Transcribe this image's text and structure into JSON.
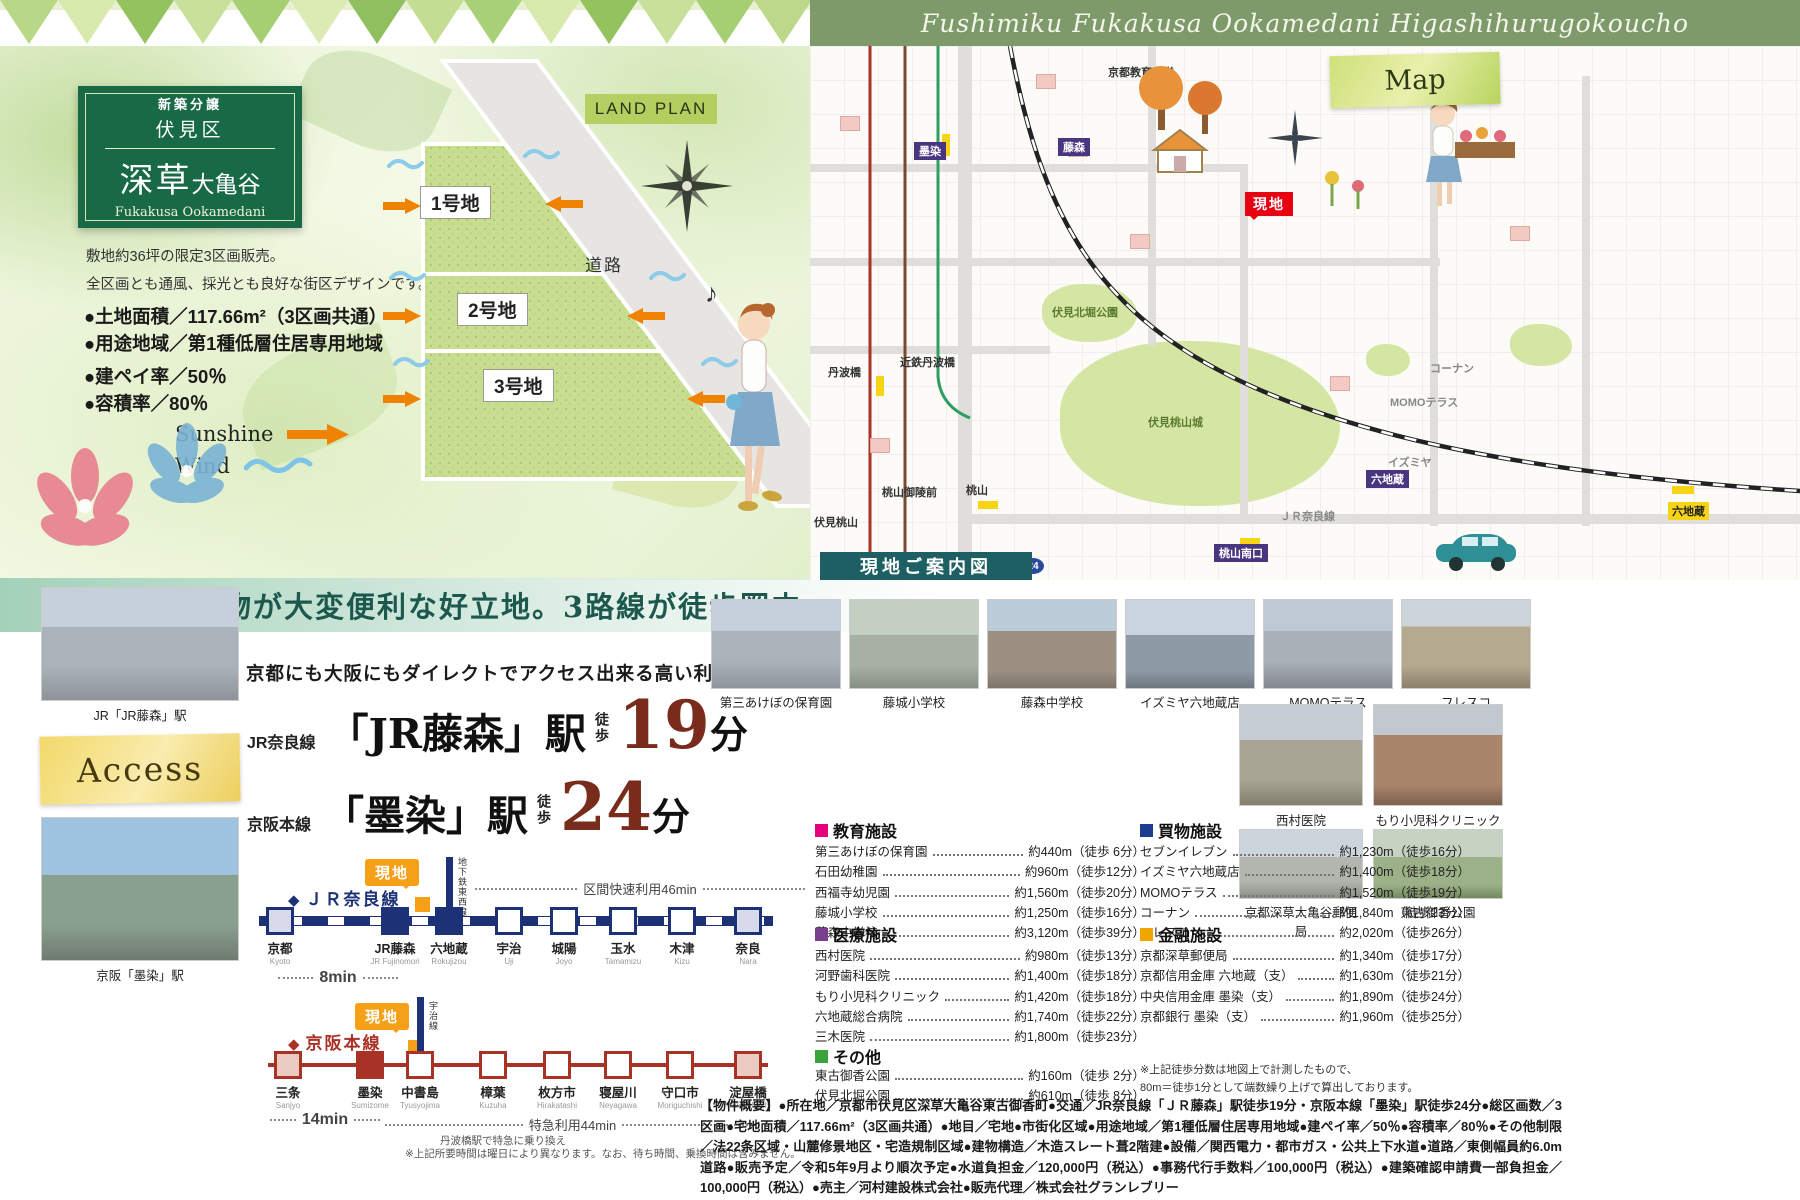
{
  "header": {
    "banner": "Fushimiku Fukakusa Ookamedani Higashihurugokoucho"
  },
  "badge": {
    "tag": "新築分譲",
    "district": "伏見区",
    "name_main": "深草",
    "name_sub": "大亀谷",
    "romaji": "Fukakusa Ookamedani"
  },
  "intro": {
    "line1": "敷地約36坪の限定3区画販売。",
    "line2": "全区画とも通風、採光とも良好な街区デザインです。",
    "spec1": "●土地面積／117.66m²（3区画共通）",
    "spec2": "●用途地域／第1種低層住居専用地域",
    "spec3": "●建ペイ率／50％",
    "spec4": "●容積率／80％"
  },
  "landplan": {
    "title": "LAND PLAN",
    "road": "道路",
    "lot1": "1号地",
    "lot2": "2号地",
    "lot3": "3号地",
    "sunshine": "Sunshine",
    "wind": "Wind",
    "notes": "♪"
  },
  "band": {
    "text": "交通、買物が大変便利な好立地。3路線が徒歩圏内。"
  },
  "map": {
    "label": "Map",
    "caption": "現地ご案内図",
    "site": "現地",
    "labels": {
      "kyoikudai": "京都教育大学",
      "sumizome": "墨染",
      "fujinomori": "藤森",
      "tanbabashi": "丹波橋",
      "kintetsu_tanbabashi": "近鉄丹波橋",
      "momoyamagoryomae": "桃山御陵前",
      "fushimimomoyama": "伏見桃山",
      "momoyama": "桃山",
      "momoyamaminamiguchi": "桃山南口",
      "rokujizo1": "六地蔵",
      "rokujizo2": "六地蔵",
      "kitabori": "伏見北堀公園",
      "momoyamajo": "伏見桃山城",
      "jrnara": "ＪＲ奈良線",
      "route24": "24",
      "momoterrace": "MOMOテラス",
      "izumiya": "イズミヤ",
      "konan": "コーナン"
    }
  },
  "access": {
    "headline": "京都にも大阪にもダイレクトでアクセス出来る高い利便性。",
    "photo1_caption": "JR「JR藤森」駅",
    "photo2_caption": "京阪「墨染」駅",
    "access_label": "Access",
    "jr": {
      "line": "JR奈良線",
      "station": "「JR藤森」駅",
      "walk": "徒歩",
      "minutes": "19",
      "unit": "分"
    },
    "keihan": {
      "line": "京阪本線",
      "station": "「墨染」駅",
      "walk": "徒歩",
      "minutes": "24",
      "unit": "分"
    },
    "jr_diagram": {
      "title": "ＪＲ奈良線",
      "site": "現地",
      "subway": "地下鉄東西線",
      "express": "区間快速利用46min",
      "local": "8min",
      "stations": [
        {
          "name": "京都",
          "romaji": "Kyoto"
        },
        {
          "name": "JR藤森",
          "romaji": "JR Fujinomori"
        },
        {
          "name": "六地蔵",
          "romaji": "Rokujizou"
        },
        {
          "name": "宇治",
          "romaji": "Uji"
        },
        {
          "name": "城陽",
          "romaji": "Joyo"
        },
        {
          "name": "玉水",
          "romaji": "Tamamizu"
        },
        {
          "name": "木津",
          "romaji": "Kizu"
        },
        {
          "name": "奈良",
          "romaji": "Nara"
        }
      ]
    },
    "keihan_diagram": {
      "title": "京阪本線",
      "site": "現地",
      "ujiline": "宇治線",
      "express": "特急利用44min",
      "local": "14min",
      "transfer": "丹波橋駅で特急に乗り換え",
      "stations": [
        {
          "name": "三条",
          "romaji": "Sanjyo"
        },
        {
          "name": "墨染",
          "romaji": "Sumizome"
        },
        {
          "name": "中書島",
          "romaji": "Tyusyojima"
        },
        {
          "name": "樟葉",
          "romaji": "Kuzuha"
        },
        {
          "name": "枚方市",
          "romaji": "Hirakatashi"
        },
        {
          "name": "寝屋川",
          "romaji": "Neyagawa"
        },
        {
          "name": "守口市",
          "romaji": "Moriguchishi"
        },
        {
          "name": "淀屋橋",
          "romaji": "Yodoyabashi"
        }
      ]
    },
    "note": "※上記所要時間は曜日により異なります。なお、待ち時間、乗換時間は含みません。"
  },
  "facilities": {
    "photos": [
      "第三あけぼの保育園",
      "藤城小学校",
      "藤森中学校",
      "イズミヤ六地蔵店",
      "MOMOテラス",
      "フレスコ"
    ],
    "right_photos": [
      "西村医院",
      "もり小児科クリニック",
      "京都深草大亀谷郵便局",
      "東古御香公園"
    ],
    "education": {
      "title": "教育施設",
      "items": [
        {
          "name": "第三あけぼの保育園",
          "value": "約440m（徒歩 6分）"
        },
        {
          "name": "石田幼稚園",
          "value": "約960m（徒歩12分）"
        },
        {
          "name": "西福寺幼児園",
          "value": "約1,560m（徒歩20分）"
        },
        {
          "name": "藤城小学校",
          "value": "約1,250m（徒歩16分）"
        },
        {
          "name": "藤森中学校",
          "value": "約3,120m（徒歩39分）"
        }
      ]
    },
    "shopping": {
      "title": "買物施設",
      "items": [
        {
          "name": "セブンイレブン",
          "value": "約1,230m（徒歩16分）"
        },
        {
          "name": "イズミヤ六地蔵店",
          "value": "約1,400m（徒歩18分）"
        },
        {
          "name": "MOMOテラス",
          "value": "約1,520m（徒歩19分）"
        },
        {
          "name": "コーナン",
          "value": "約1,840m（徒歩23分）"
        },
        {
          "name": "フレスコ",
          "value": "約2,020m（徒歩26分）"
        }
      ]
    },
    "medical": {
      "title": "医療施設",
      "items": [
        {
          "name": "西村医院",
          "value": "約980m（徒歩13分）"
        },
        {
          "name": "河野歯科医院",
          "value": "約1,400m（徒歩18分）"
        },
        {
          "name": "もり小児科クリニック",
          "value": "約1,420m（徒歩18分）"
        },
        {
          "name": "六地蔵総合病院",
          "value": "約1,740m（徒歩22分）"
        },
        {
          "name": "三木医院",
          "value": "約1,800m（徒歩23分）"
        }
      ]
    },
    "finance": {
      "title": "金融施設",
      "items": [
        {
          "name": "京都深草郵便局",
          "value": "約1,340m（徒歩17分）"
        },
        {
          "name": "京都信用金庫 六地蔵（支）",
          "value": "約1,630m（徒歩21分）"
        },
        {
          "name": "中央信用金庫 墨染（支）",
          "value": "約1,890m（徒歩24分）"
        },
        {
          "name": "京都銀行 墨染（支）",
          "value": "約1,960m（徒歩25分）"
        }
      ]
    },
    "other": {
      "title": "その他",
      "items": [
        {
          "name": "東古御香公園",
          "value": "約160m（徒歩 2分）"
        },
        {
          "name": "伏見北堀公園",
          "value": "約610m（徒歩 8分）"
        }
      ]
    },
    "walk_note1": "※上記徒歩分数は地図上で計測したもので、",
    "walk_note2": "80m＝徒歩1分として端数繰り上げで算出しております。"
  },
  "overview": "【物件概要】●所在地／京都市伏見区深草大亀谷東古御香町●交通／JR奈良線「ＪＲ藤森」駅徒歩19分・京阪本線「墨染」駅徒歩24分●総区画数／3区画●宅地面積／117.66m²（3区画共通）●地目／宅地●市街化区域●用途地域／第1種低層住居専用地域●建ペイ率／50％●容積率／80％●その他制限／法22条区域・山麓修景地区・宅造規制区域●建物構造／木造スレート葺2階建●設備／関西電力・都市ガス・公共上下水道●道路／東側幅員約6.0m道路●販売予定／令和5年9月より順次予定●水道負担金／120,000円（税込）●事務代行手数料／100,000円（税込）●建築確認申請費一部負担金／100,000円（税込）●売主／河村建設株式会社●販売代理／株式会社グランレブリー",
  "colors": {
    "badge_green": "#176a45",
    "banner_green": "#7e9a6b",
    "jr_navy": "#1d3276",
    "keihan_red": "#a93226",
    "site_orange": "#f6a018",
    "minutes_brown": "#7a2c1c",
    "caption_teal": "#1d5f63",
    "site_red": "#e60012"
  }
}
